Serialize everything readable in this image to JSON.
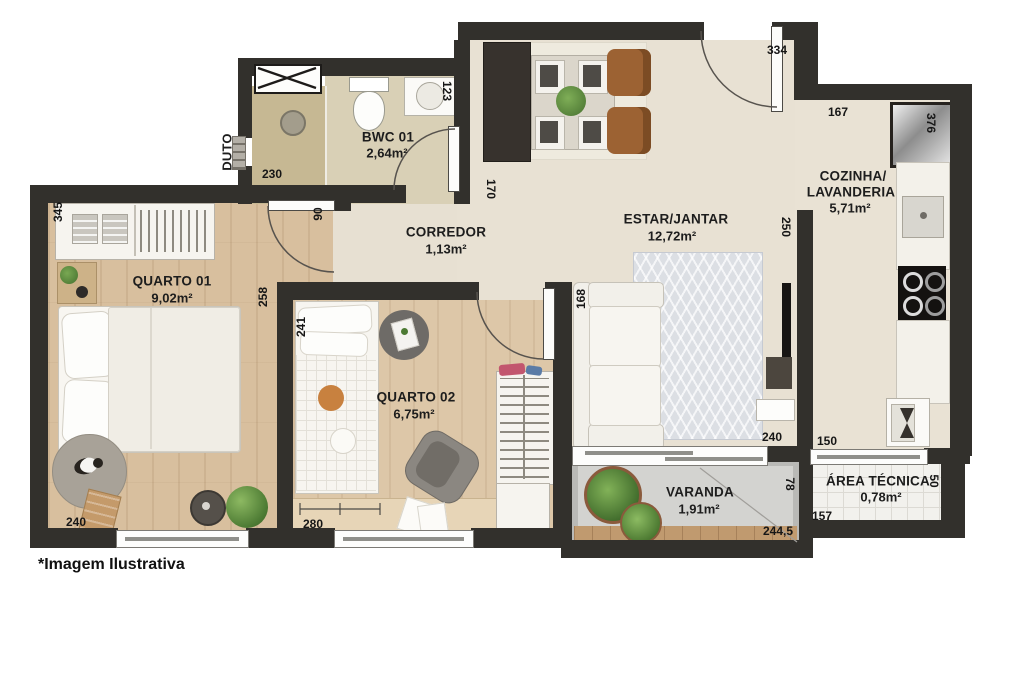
{
  "footnote": "*Imagem Ilustrativa",
  "rooms": {
    "bwc": {
      "name": "BWC 01",
      "area": "2,64m²"
    },
    "corredor": {
      "name": "CORREDOR",
      "area": "1,13m²"
    },
    "estar": {
      "name": "ESTAR/JANTAR",
      "area": "12,72m²"
    },
    "cozinha": {
      "name_line1": "COZINHA/",
      "name_line2": "LAVANDERIA",
      "area": "5,71m²"
    },
    "quarto01": {
      "name": "QUARTO 01",
      "area": "9,02m²"
    },
    "quarto02": {
      "name": "QUARTO 02",
      "area": "6,75m²"
    },
    "varanda": {
      "name": "VARANDA",
      "area": "1,91m²"
    },
    "area_tecnica": {
      "name": "ÁREA TÉCNICA",
      "area": "0,78m²"
    },
    "duto": {
      "name": "DUTO"
    }
  },
  "dimensions_cm": {
    "entry_wall": "334",
    "kitchen_top": "167",
    "fridge_side": "376",
    "bwc_width": "123",
    "corridor_opening": "170",
    "shower_width": "230",
    "quarto01_left": "345",
    "quarto01_door": "90",
    "quarto01_right": "258",
    "quarto01_bottom": "240",
    "quarto02_left": "241",
    "quarto02_bottom": "280",
    "estar_cozinha_wall": "250",
    "sofa_wall": "168",
    "estar_bottom": "240",
    "kitchen_bottom": "150",
    "varanda_depth": "78",
    "varanda_bottom": "244,5",
    "area_tecnica_width": "157",
    "area_tecnica_depth": "50"
  },
  "colors": {
    "wall": "#32302c",
    "floor_cream": "#e8e1d3",
    "floor_wood": "#d8bf9e",
    "floor_bwc": "#d9d0b6",
    "floor_shower": "#c6b893",
    "floor_varanda": "#cbcbc8",
    "floor_area_tecnica": "#f2f1ed",
    "accent_plant": "#5d8f46",
    "accent_chair_brown": "#9c6233"
  }
}
